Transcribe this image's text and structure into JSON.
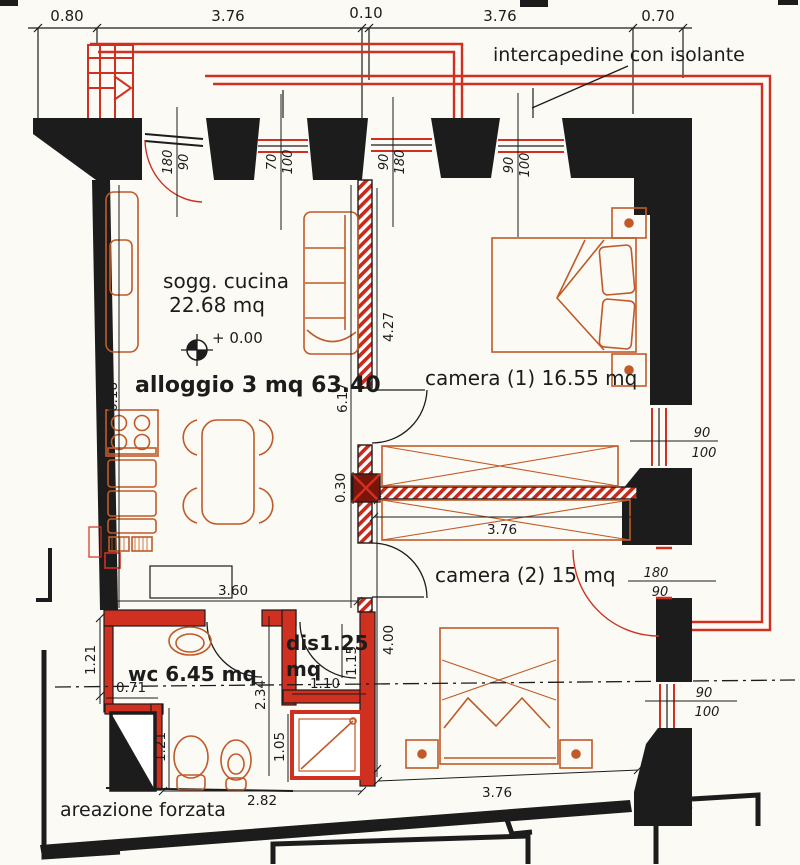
{
  "drawing": {
    "type": "floor-plan",
    "annotation_note": "intercapedine con isolante",
    "areazione_label": "areazione forzata"
  },
  "colors": {
    "wall_black": "#1c1c1c",
    "new_wall_red": "#d03020",
    "furniture_orange": "#c05a28",
    "paper": "#fbfaf5"
  },
  "rooms": {
    "sogg_line1": "sogg. cucina",
    "sogg_line2": "22.68 mq",
    "level_mark": "+ 0.00",
    "alloggio": "alloggio 3 mq 63.40",
    "camera1": "camera (1) 16.55 mq",
    "camera2": "camera (2) 15 mq",
    "wc": "wc 6.45 mq",
    "dis_line1": "dis1.25",
    "dis_line2": "mq"
  },
  "dims_top": [
    "0.80",
    "3.76",
    "0.10",
    "3.76",
    "0.70"
  ],
  "dims": {
    "d618": "6.18",
    "d617": "6.17",
    "d427": "4.27",
    "d030": "0.30",
    "d376w": "3.76",
    "d400": "4.00",
    "d360": "3.60",
    "d110": "1.10",
    "d115": "1.15",
    "d234": "2.34",
    "d105": "1.05",
    "d121a": "1.21",
    "d121b": "1.21",
    "d071": "0.71",
    "d282": "2.82",
    "d376b": "3.76"
  },
  "openings": {
    "entry": [
      "180",
      "90"
    ],
    "win_top_left": [
      "70",
      "100"
    ],
    "door_cam1_top": [
      "90",
      "180"
    ],
    "win_top_right": [
      "90",
      "100"
    ],
    "win_right_mid": [
      "90",
      "100"
    ],
    "door_right": [
      "180",
      "90"
    ],
    "win_right_bottom": [
      "90",
      "100"
    ]
  }
}
